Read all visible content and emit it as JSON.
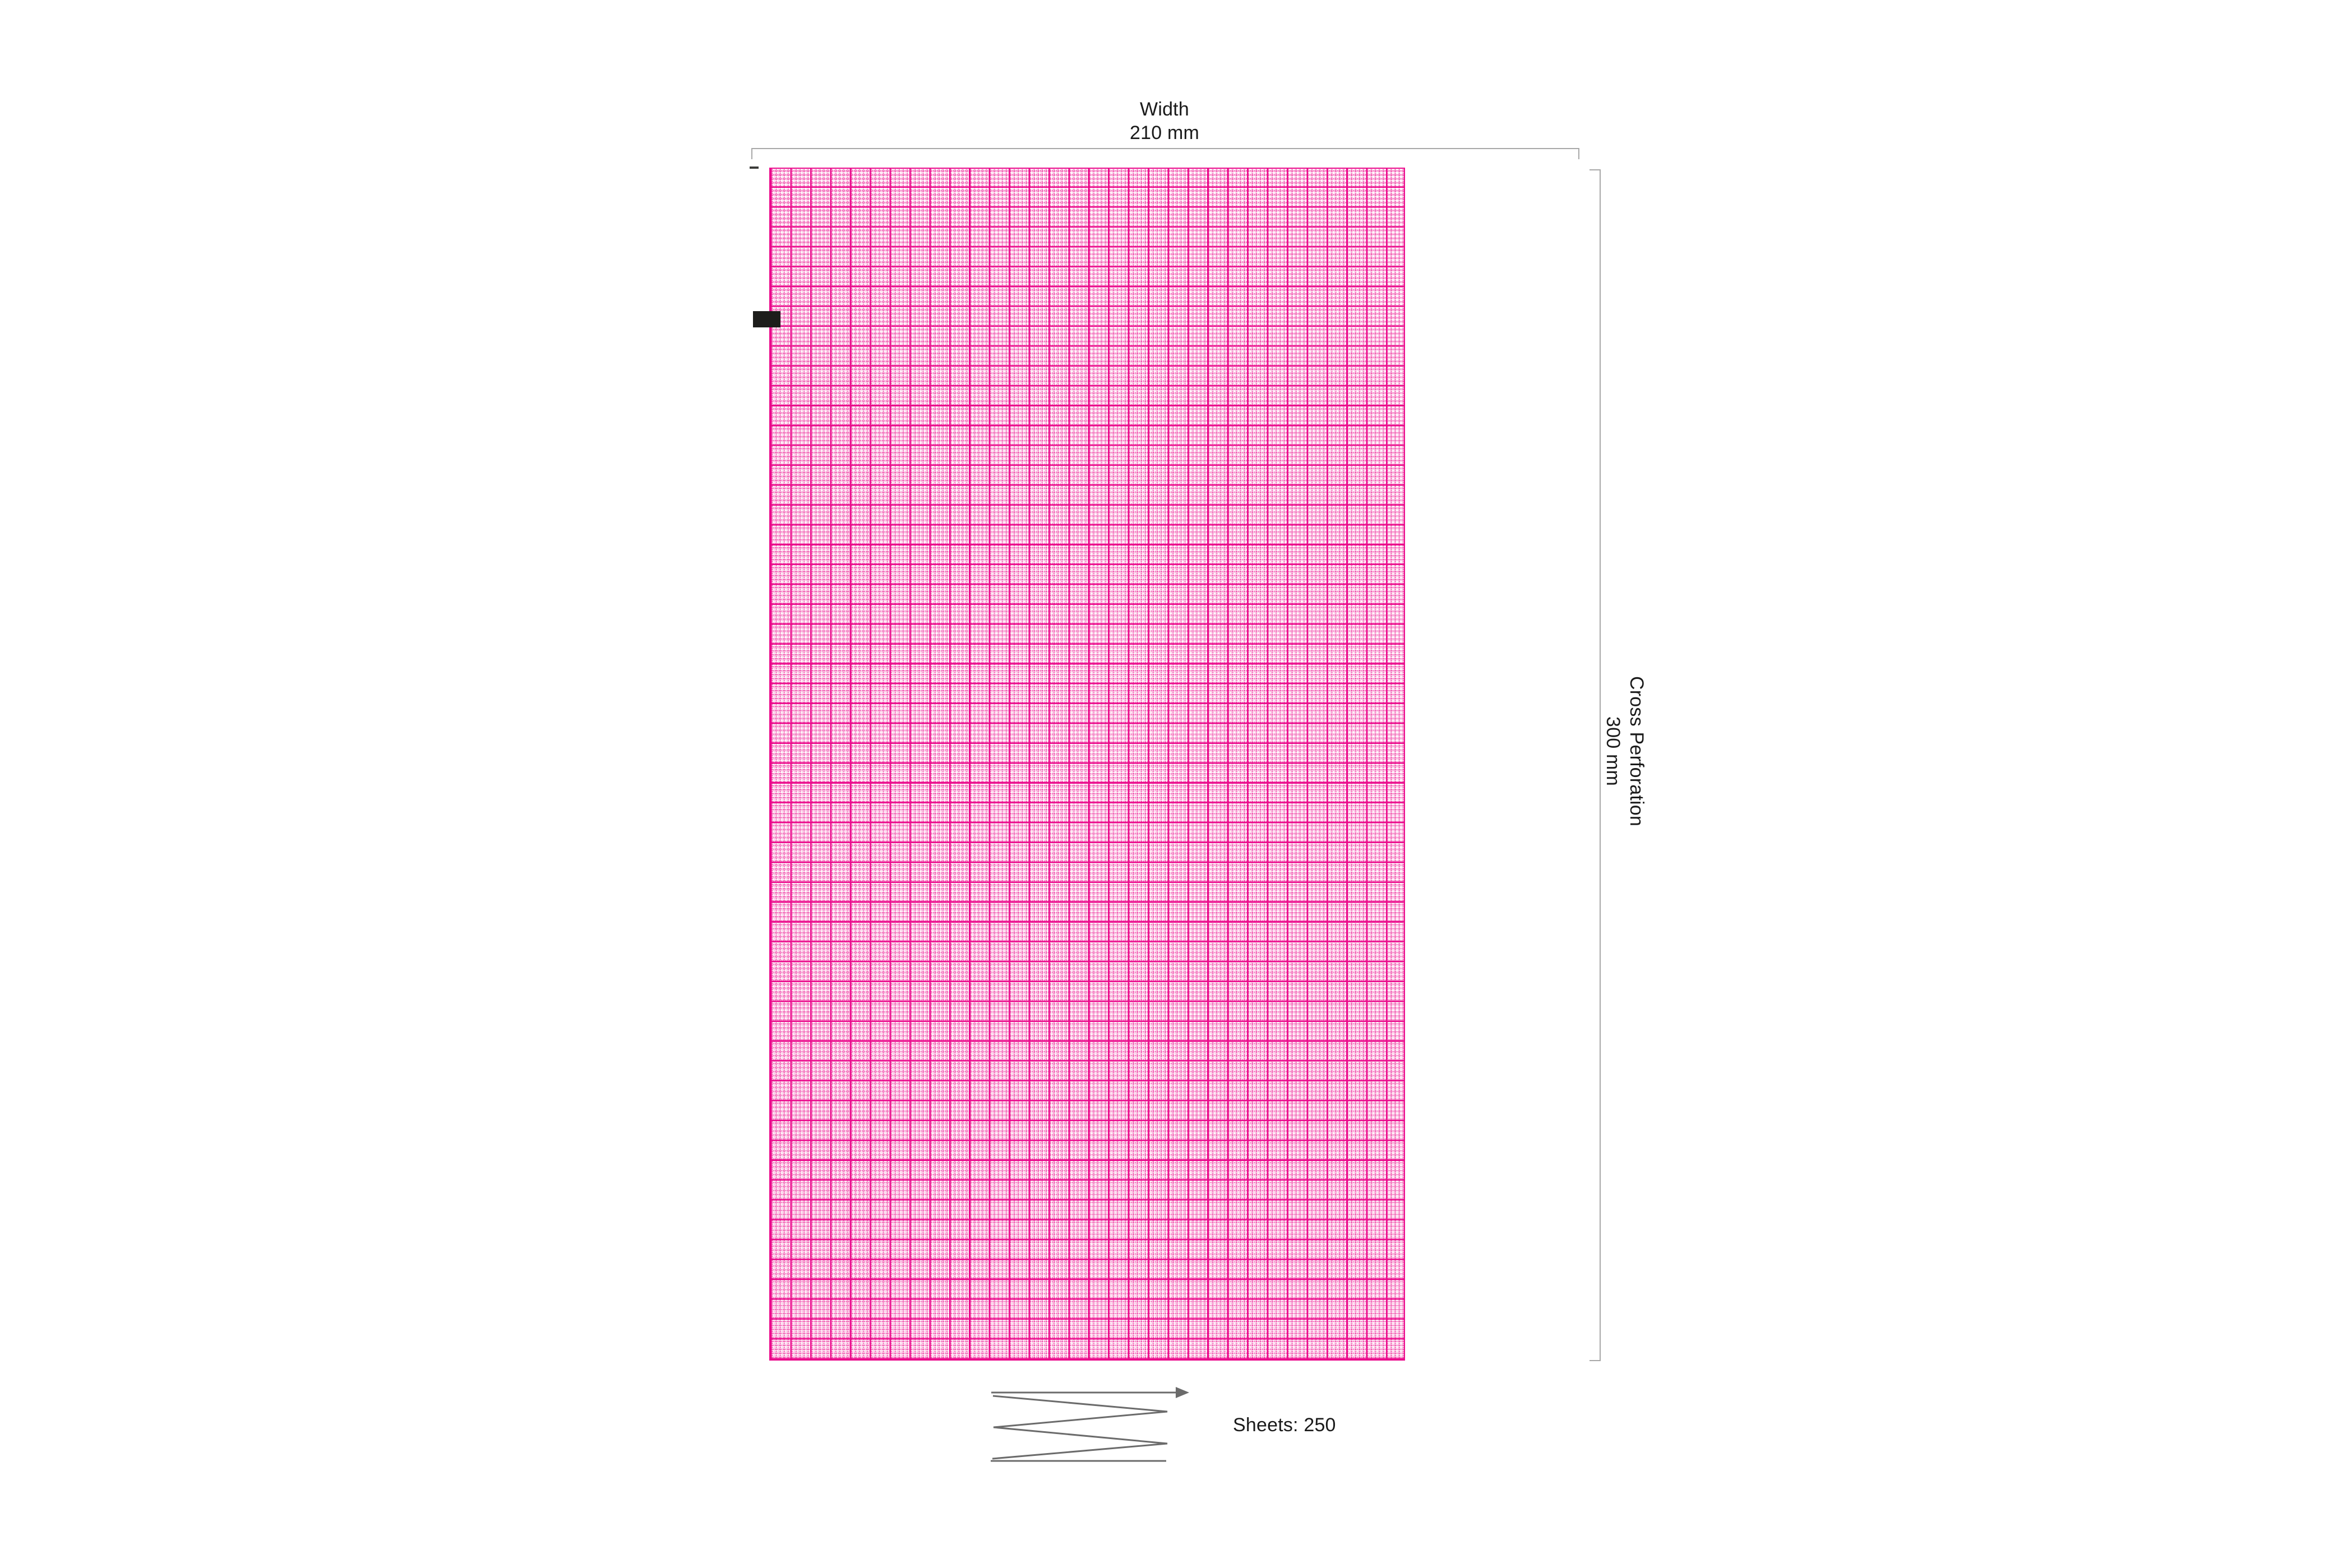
{
  "labels": {
    "width": {
      "title": "Width",
      "value": "210 mm"
    },
    "cross_perforation": {
      "title": "Cross Perforation",
      "value": "300 mm"
    },
    "sheets": "Sheets: 250"
  },
  "icons": {
    "z_fold": "z-fold-arrow-icon",
    "cue_mark": "cue-mark-block"
  },
  "colors": {
    "background": "#ffffff",
    "grid_major": "#eb0b8c",
    "grid_minor": "rgba(235,11,140,0.55)",
    "grid_minor_soft": "rgba(235,11,140,0.18)",
    "dimension_line": "#a8a8a8",
    "zfold_line": "#6b6b6b",
    "cue_mark": "#1d1d1b",
    "edge_mark": "#3c3c3a",
    "text": "#1a1a1a"
  }
}
